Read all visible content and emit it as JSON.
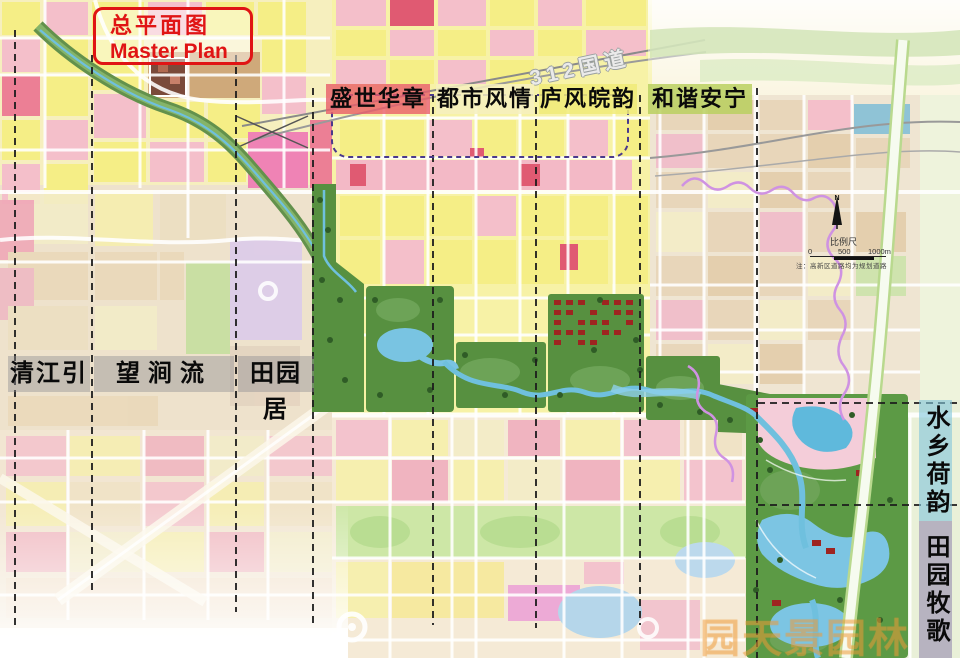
{
  "title": {
    "line1_zh": "总平面图",
    "line2_en": "Master Plan"
  },
  "highway_label": "312国道",
  "zones_top": [
    {
      "label": "盛世华章"
    },
    {
      "label": "都市风情"
    },
    {
      "label": "庐风皖韵"
    },
    {
      "label": "和谐安宁"
    }
  ],
  "zones_left": [
    {
      "label": "清江引"
    },
    {
      "label": "望涧流"
    },
    {
      "label": "田园居"
    }
  ],
  "zones_right": [
    {
      "label": "水乡荷韵"
    },
    {
      "label": "田园牧歌"
    }
  ],
  "map_tools": {
    "north_label": "N",
    "scale_title": "比例尺",
    "scale_ticks": [
      "0",
      "500",
      "1000m"
    ],
    "note": "注：高新区道路均为规划道路"
  },
  "watermark": {
    "line1": "园天景园林",
    "line2": "c918.com.cn"
  },
  "colors": {
    "title_red": "#e01414",
    "label_text": "#0a0a0a",
    "zone_top_bgs": [
      "rgba(232,93,105,0.80)",
      "rgba(246,240,190,0.85)",
      "rgba(240,235,120,0.85)",
      "rgba(186,208,96,0.85)"
    ],
    "zone_left_bg": "rgba(140,140,145,0.42)",
    "zone_right_bgs": [
      "rgba(132,198,220,0.62)",
      "rgba(152,142,178,0.62)"
    ],
    "section_dash": "#1c1c1c",
    "plan_outline_dash": "#4a3a8c",
    "park_green": "#579040",
    "river_blue": "#6fc0de"
  }
}
